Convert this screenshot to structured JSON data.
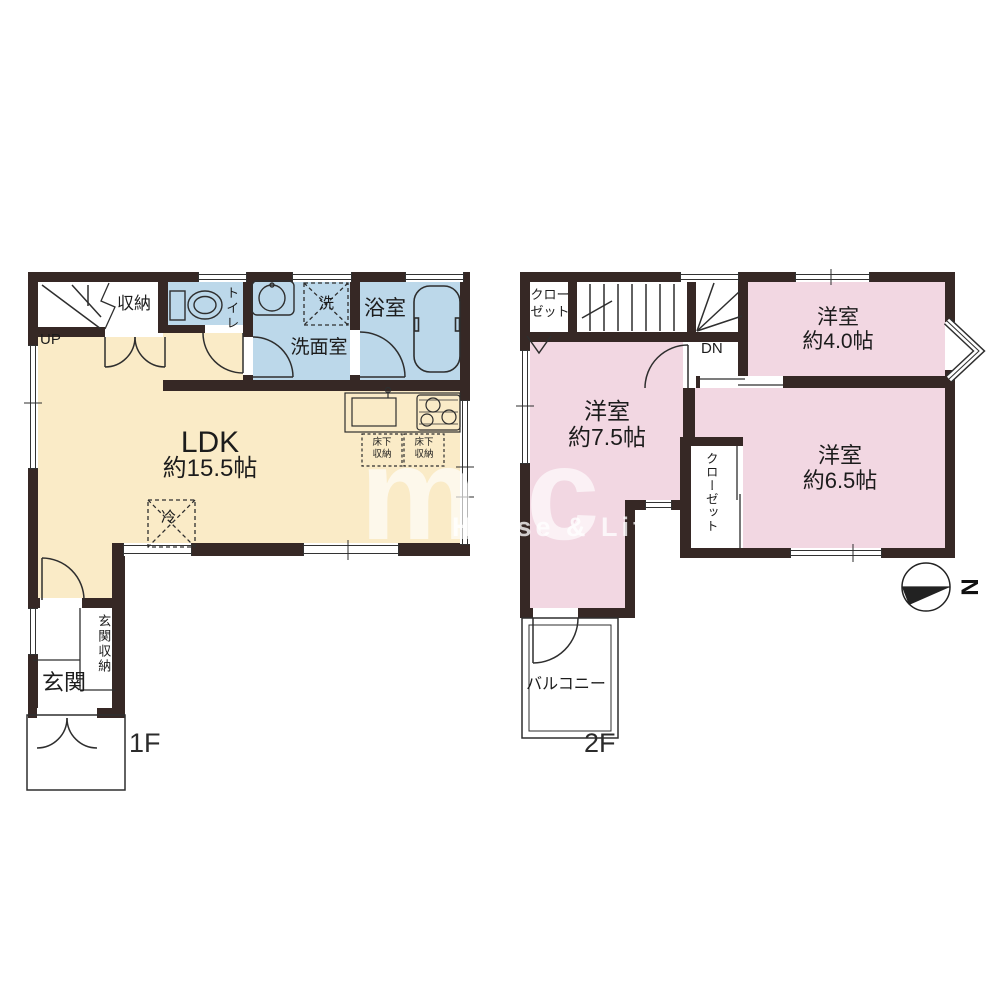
{
  "colors": {
    "wall": "#362825",
    "ldk_fill": "#FAEBC7",
    "wet_room_fill": "#BCD8EA",
    "bedroom_fill": "#F2D7E2",
    "background": "#ffffff"
  },
  "watermark": {
    "logo": "mic",
    "tagline": "House & Life"
  },
  "compass": {
    "north_label": "N"
  },
  "floor1": {
    "label": "1F",
    "up": "UP",
    "storage": "収納",
    "toilet": "トイレ",
    "washer": "洗",
    "washroom": "洗面室",
    "bathroom": "浴室",
    "ldk_name": "LDK",
    "ldk_size": "約15.5帖",
    "underfloor_line1": "床下",
    "underfloor_line2": "収納",
    "fridge": "冷",
    "entrance": "玄関",
    "entrance_storage": "玄関収納"
  },
  "floor2": {
    "label": "2F",
    "closet_line1": "クロー",
    "closet_line2": "ゼット",
    "dn": "DN",
    "room_a_name": "洋室",
    "room_a_size": "約4.0帖",
    "room_b_name": "洋室",
    "room_b_size": "約7.5帖",
    "room_c_name": "洋室",
    "room_c_size": "約6.5帖",
    "closet_vertical": "クローゼット",
    "balcony": "バルコニー"
  }
}
